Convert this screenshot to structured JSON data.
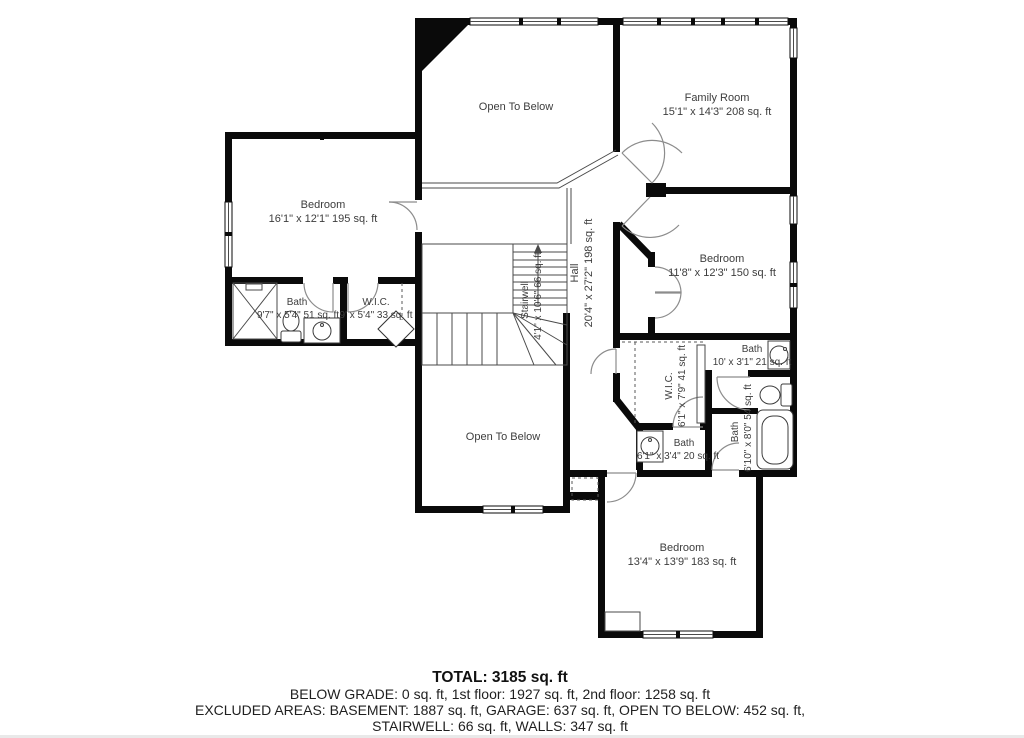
{
  "colors": {
    "background": "#ffffff",
    "wall": "#0a0a0a",
    "thin_line": "#4a4a4a",
    "door_arc": "#8c8c8c",
    "label_text": "#3d3d3d",
    "summary_text": "#1f1f1f"
  },
  "rooms": {
    "open_below_top": {
      "name": "Open To Below"
    },
    "family": {
      "name": "Family Room",
      "dims": "15'1\" x 14'3\" 208 sq. ft"
    },
    "bedroom_left": {
      "name": "Bedroom",
      "dims": "16'1\" x 12'1\" 195 sq. ft"
    },
    "bath_left": {
      "name": "Bath",
      "dims": "9'7\" x 5'4\" 51 sq. ft"
    },
    "wic_left": {
      "name": "W.I.C.",
      "dims": "9' x 5'4\" 33 sq. ft"
    },
    "stairwell": {
      "name": "Stairwell",
      "dims": "4'1\" x 10'6\" 66 sq. ft"
    },
    "hall": {
      "name": "Hall",
      "dims": "20'4\" x 27'2\" 198 sq. ft"
    },
    "bedroom_right": {
      "name": "Bedroom",
      "dims": "11'8\" x 12'3\" 150 sq. ft"
    },
    "bath_top": {
      "name": "Bath",
      "dims": "10' x 3'1\" 21 sq. ft"
    },
    "wic_right": {
      "name": "W.I.C.",
      "dims": "6'1\" x 7'9\" 41 sq. ft"
    },
    "bath_tub": {
      "name": "Bath",
      "dims": "6'10\" x 8'0\" 54 sq. ft"
    },
    "bath_small": {
      "name": "Bath",
      "dims": "6'1\" x 3'4\" 20 sq. ft"
    },
    "open_below_bottom": {
      "name": "Open To Below"
    },
    "bedroom_bottom": {
      "name": "Bedroom",
      "dims": "13'4\" x 13'9\" 183 sq. ft"
    }
  },
  "summary": {
    "total": "TOTAL: 3185 sq. ft",
    "line1": "BELOW GRADE: 0 sq. ft, 1st floor: 1927 sq. ft, 2nd floor: 1258 sq. ft",
    "line2": "EXCLUDED AREAS: BASEMENT: 1887 sq. ft, GARAGE: 637 sq. ft, OPEN TO BELOW: 452 sq. ft,",
    "line3": "STAIRWELL: 66 sq. ft, WALLS: 347 sq. ft"
  }
}
